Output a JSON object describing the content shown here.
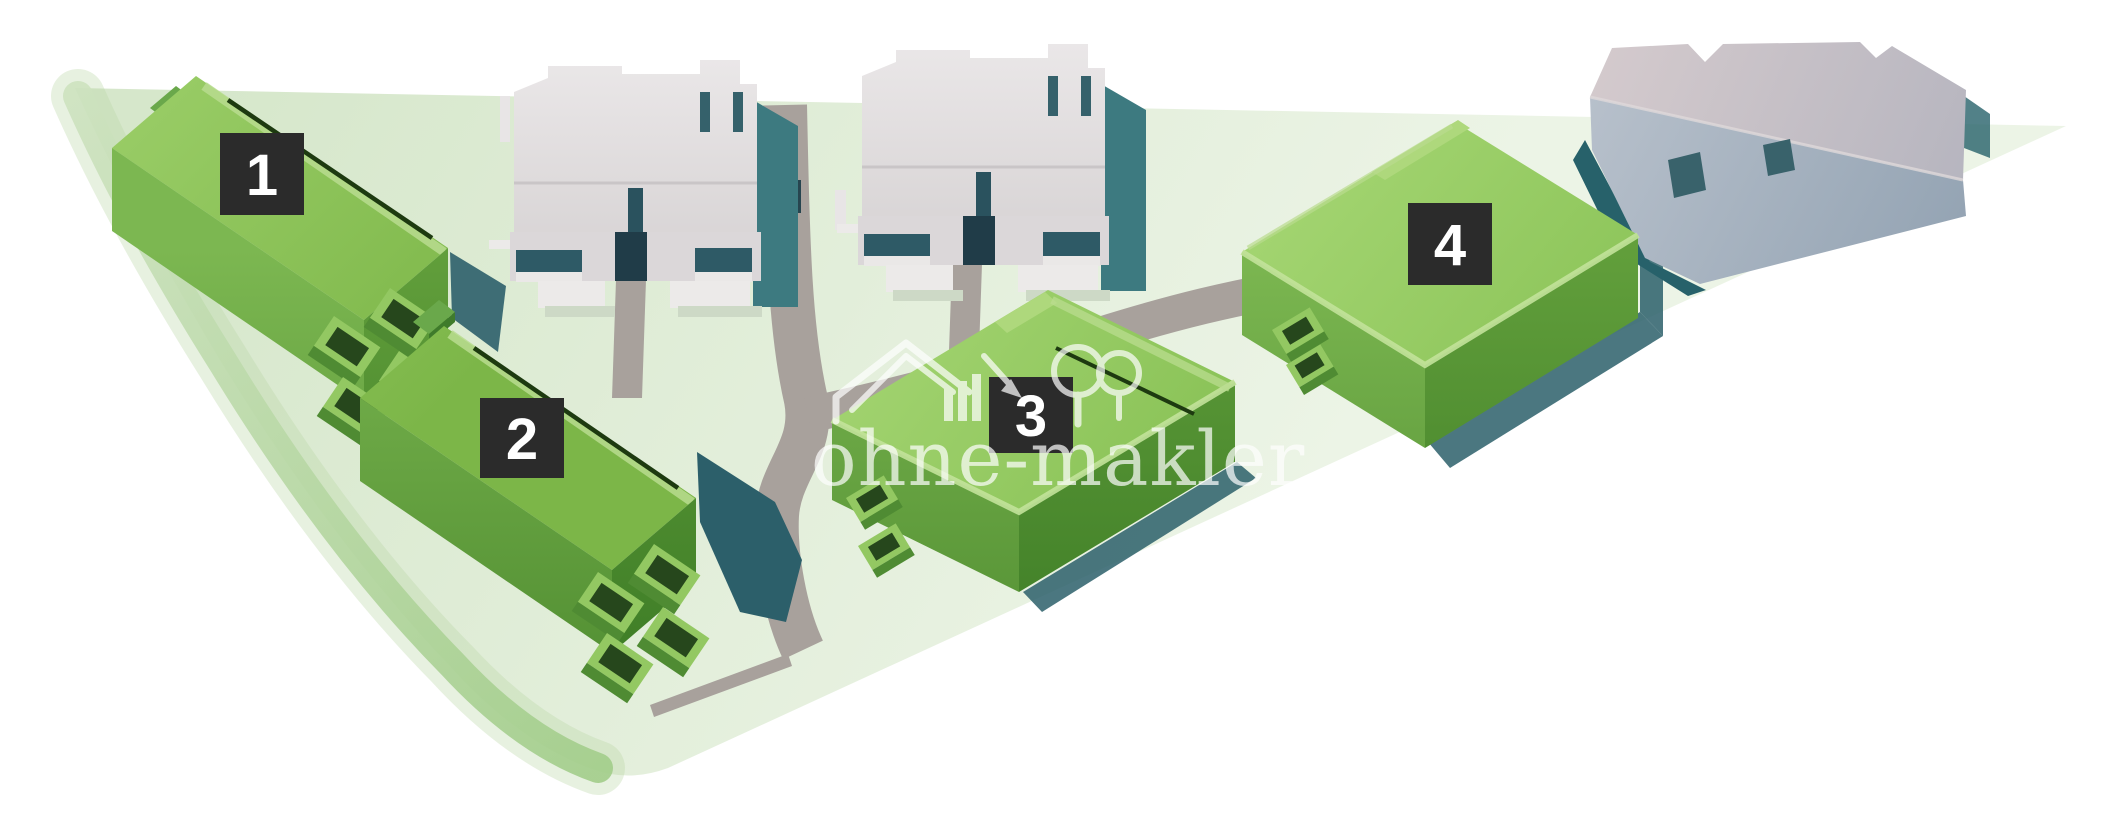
{
  "scene": {
    "description": "3D site plan rendering of a residential development with four numbered new-build houses, two white apartment blocks and one existing gray building",
    "background_color": "#ffffff"
  },
  "site": {
    "ground_color": "#dfecd8",
    "ground_edge_color": "#aed49a",
    "road_color": "#a8a19c",
    "shadow_color": "#2c5f6a"
  },
  "buildings": {
    "green_roof_color": "#8cc152",
    "green_wall_color": "#5d9a38",
    "gray_building_color": "#ddd9da",
    "existing_building_color": "#b7c0cb",
    "labeled": [
      {
        "id": "building-1",
        "label": "1"
      },
      {
        "id": "building-2",
        "label": "2"
      },
      {
        "id": "building-3",
        "label": "3"
      },
      {
        "id": "building-4",
        "label": "4"
      }
    ],
    "label_style": {
      "background_color": "#2b2b2b",
      "text_color": "#ffffff"
    }
  },
  "watermark": {
    "text": "ohne-makler",
    "logo": "house-arrow-trees",
    "color": "#ffffff"
  }
}
